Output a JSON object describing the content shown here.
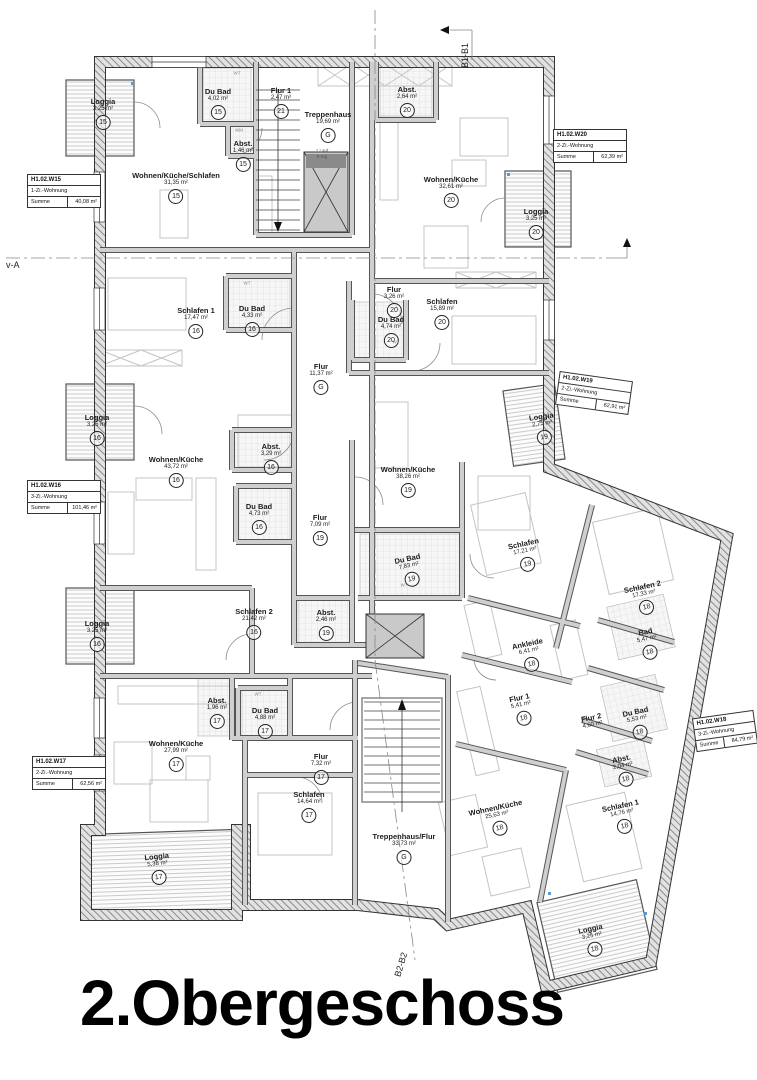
{
  "title": "2.Obergeschoss",
  "sections": {
    "b1": "B1-B1",
    "b2": "B2-B2",
    "a": "v-A"
  },
  "stairs": {
    "note_line1": "1.Lauf",
    "note_line2": "9 Stg"
  },
  "fixtures": [
    "WT",
    "WM",
    "WT",
    "WT",
    "WT",
    "WT"
  ],
  "info_boxes": [
    {
      "id": "H1.02.W15",
      "type": "1-Zi.-Wohnung",
      "sum_label": "Summe",
      "sum": "40,08 m²"
    },
    {
      "id": "H1.02.W20",
      "type": "2-Zi.-Wohnung",
      "sum_label": "Summe",
      "sum": "62,39 m²"
    },
    {
      "id": "H1.02.W19",
      "type": "2-Zi.-Wohnung",
      "sum_label": "Summe",
      "sum": "62,91 m²"
    },
    {
      "id": "H1.02.W16",
      "type": "3-Zi.-Wohnung",
      "sum_label": "Summe",
      "sum": "101,46 m²"
    },
    {
      "id": "H1.02.W17",
      "type": "2-Zi.-Wohnung",
      "sum_label": "Summe",
      "sum": "62,56 m²"
    },
    {
      "id": "H1.02.W18",
      "type": "3-Zi.-Wohnung",
      "sum_label": "Summe",
      "sum": "84,79 m²"
    }
  ],
  "rooms": [
    {
      "name": "Loggia",
      "area": "3,25 m²",
      "unit": "15"
    },
    {
      "name": "Du Bad",
      "area": "4,02 m²",
      "unit": "15"
    },
    {
      "name": "Abst.",
      "area": "1,46 m²",
      "unit": "15"
    },
    {
      "name": "Wohnen/Küche/Schlafen",
      "area": "31,35 m²",
      "unit": "15"
    },
    {
      "name": "Flur 1",
      "area": "2,47 m²",
      "unit": "21"
    },
    {
      "name": "Treppenhaus",
      "area": "19,69 m²",
      "unit": "G"
    },
    {
      "name": "Abst.",
      "area": "2,64 m²",
      "unit": "20"
    },
    {
      "name": "Wohnen/Küche",
      "area": "32,61 m²",
      "unit": "20"
    },
    {
      "name": "Loggia",
      "area": "3,25 m²",
      "unit": "20"
    },
    {
      "name": "Flur",
      "area": "3,26 m²",
      "unit": "20"
    },
    {
      "name": "Du Bad",
      "area": "4,74 m²",
      "unit": "20"
    },
    {
      "name": "Schlafen",
      "area": "15,89 m²",
      "unit": "20"
    },
    {
      "name": "Schlafen 1",
      "area": "17,47 m²",
      "unit": "16"
    },
    {
      "name": "Du Bad",
      "area": "4,33 m²",
      "unit": "16"
    },
    {
      "name": "Flur",
      "area": "11,37 m²",
      "unit": "G"
    },
    {
      "name": "Loggia",
      "area": "3,25 m²",
      "unit": "16"
    },
    {
      "name": "Wohnen/Küche",
      "area": "43,72 m²",
      "unit": "16"
    },
    {
      "name": "Abst.",
      "area": "3,29 m²",
      "unit": "16"
    },
    {
      "name": "Du Bad",
      "area": "4,73 m²",
      "unit": "16"
    },
    {
      "name": "Schlafen 2",
      "area": "21,42 m²",
      "unit": "16"
    },
    {
      "name": "Loggia",
      "area": "3,25 m²",
      "unit": "16"
    },
    {
      "name": "Loggia",
      "area": "2,75 m²",
      "unit": "19"
    },
    {
      "name": "Wohnen/Küche",
      "area": "38,26 m²",
      "unit": "19"
    },
    {
      "name": "Flur",
      "area": "7,09 m²",
      "unit": "19"
    },
    {
      "name": "Du Bad",
      "area": "7,83 m²",
      "unit": "19"
    },
    {
      "name": "Abst.",
      "area": "2,46 m²",
      "unit": "19"
    },
    {
      "name": "Schlafen",
      "area": "17,21 m²",
      "unit": "19"
    },
    {
      "name": "Abst.",
      "area": "1,96 m²",
      "unit": "17"
    },
    {
      "name": "Du Bad",
      "area": "4,88 m²",
      "unit": "17"
    },
    {
      "name": "Wohnen/Küche",
      "area": "27,99 m²",
      "unit": "17"
    },
    {
      "name": "Flur",
      "area": "7,32 m²",
      "unit": "17"
    },
    {
      "name": "Schlafen",
      "area": "14,64 m²",
      "unit": "17"
    },
    {
      "name": "Loggia",
      "area": "5,38 m²",
      "unit": "17"
    },
    {
      "name": "Treppenhaus/Flur",
      "area": "33,73 m²",
      "unit": "G"
    },
    {
      "name": "Schlafen 2",
      "area": "17,33 m²",
      "unit": "18"
    },
    {
      "name": "Bad",
      "area": "5,47 m²",
      "unit": "18"
    },
    {
      "name": "Ankleide",
      "area": "6,41 m²",
      "unit": "18"
    },
    {
      "name": "Flur 1",
      "area": "5,41 m²",
      "unit": "18"
    },
    {
      "name": "Flur 2",
      "area": "4,60 m²",
      "unit": "18"
    },
    {
      "name": "Du Bad",
      "area": "5,53 m²",
      "unit": "18"
    },
    {
      "name": "Abst.",
      "area": "2,04 m²",
      "unit": "18"
    },
    {
      "name": "Wohnen/Küche",
      "area": "25,63 m²",
      "unit": "18"
    },
    {
      "name": "Schlafen 1",
      "area": "14,76 m²",
      "unit": "18"
    },
    {
      "name": "Loggia",
      "area": "3,25 m²",
      "unit": "18"
    }
  ]
}
